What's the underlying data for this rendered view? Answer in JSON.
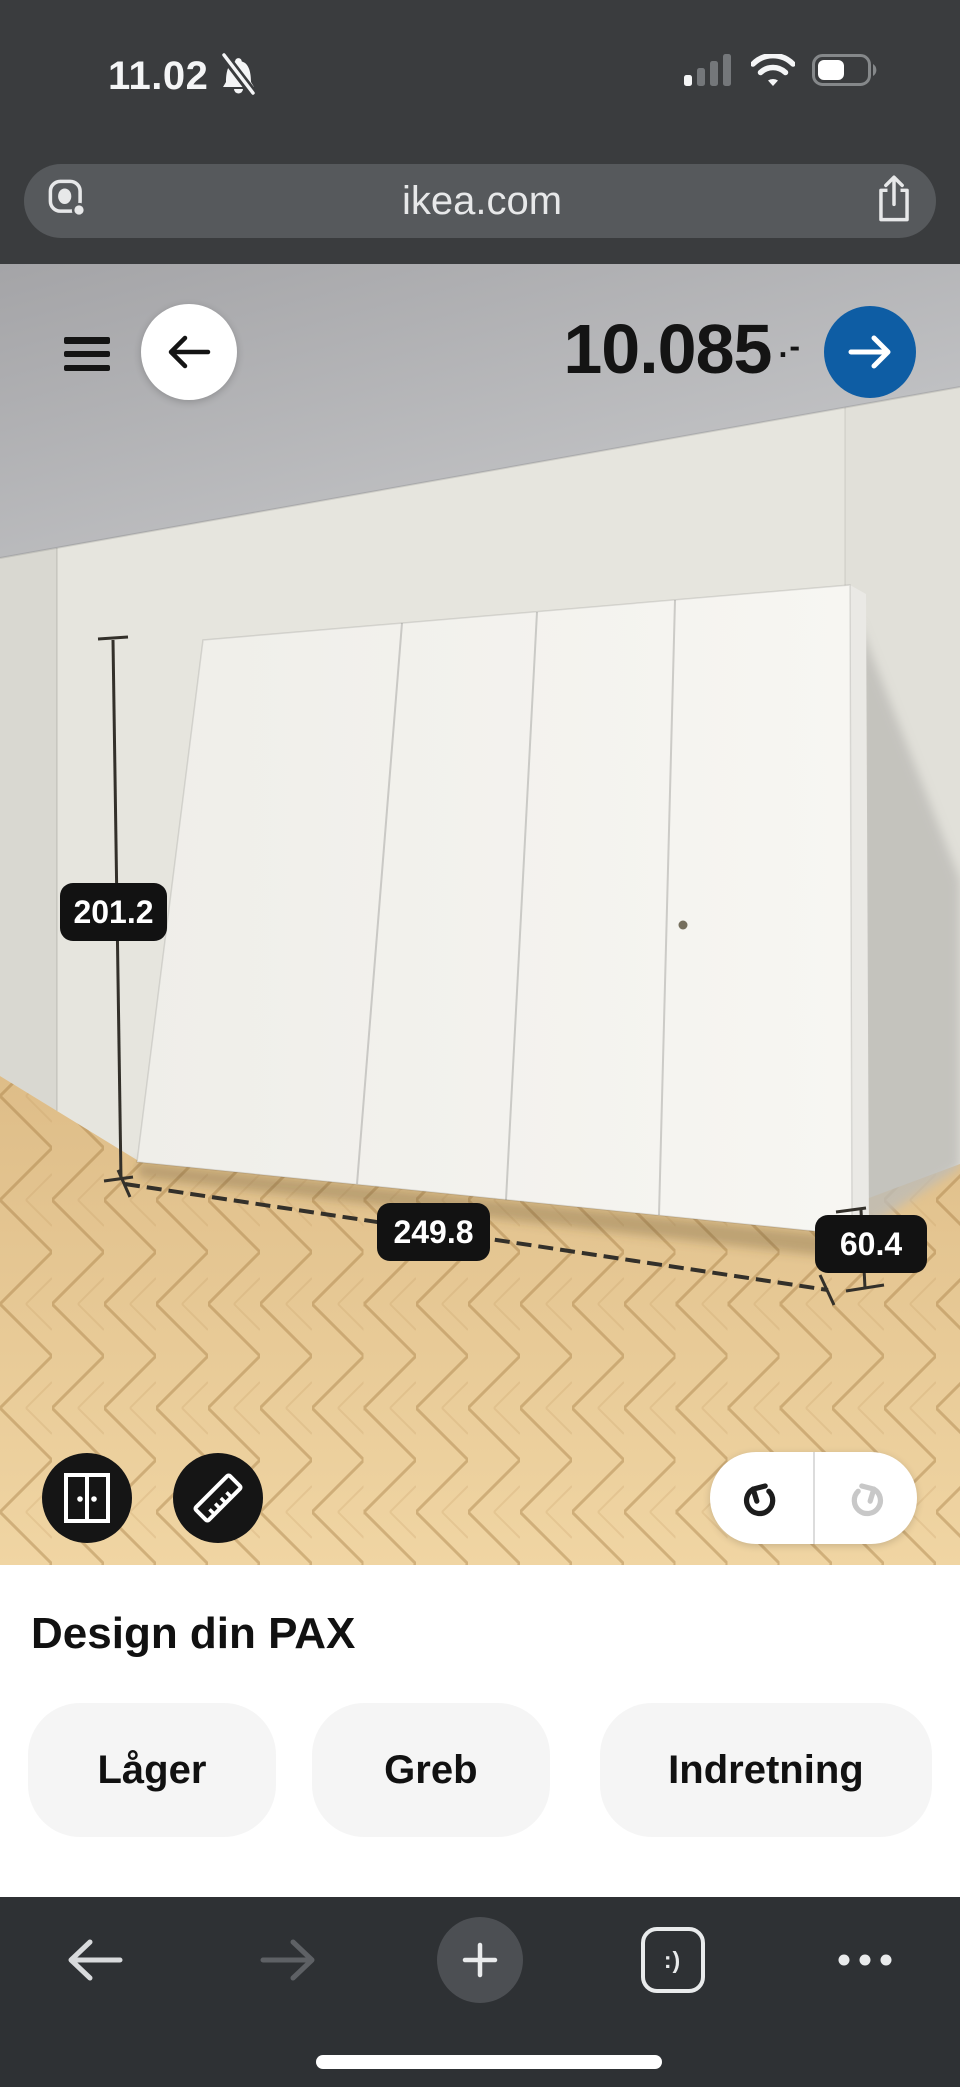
{
  "status": {
    "time": "11.02"
  },
  "urlbar": {
    "url": "ikea.com"
  },
  "planner": {
    "price": "10.085",
    "price_suffix": ".-",
    "dimensions": {
      "height": "201.2",
      "width": "249.8",
      "depth": "60.4"
    }
  },
  "section": {
    "title": "Design din PAX",
    "buttons": [
      {
        "label": "Låger"
      },
      {
        "label": "Greb"
      },
      {
        "label": "Indretning"
      }
    ]
  },
  "navbar": {
    "tab_face": ":)"
  },
  "colors": {
    "ikea_blue": "#0E5DA4",
    "chrome_top": "#3A3C3E",
    "chrome_bottom": "#2E3134",
    "url_pill": "#56595C",
    "dimension_label_bg": "#121212",
    "pill_bg": "#F5F5F5",
    "floor_wood": "#E5C894",
    "wall": "#E6E5DE",
    "ceiling": "#ABABAE"
  }
}
